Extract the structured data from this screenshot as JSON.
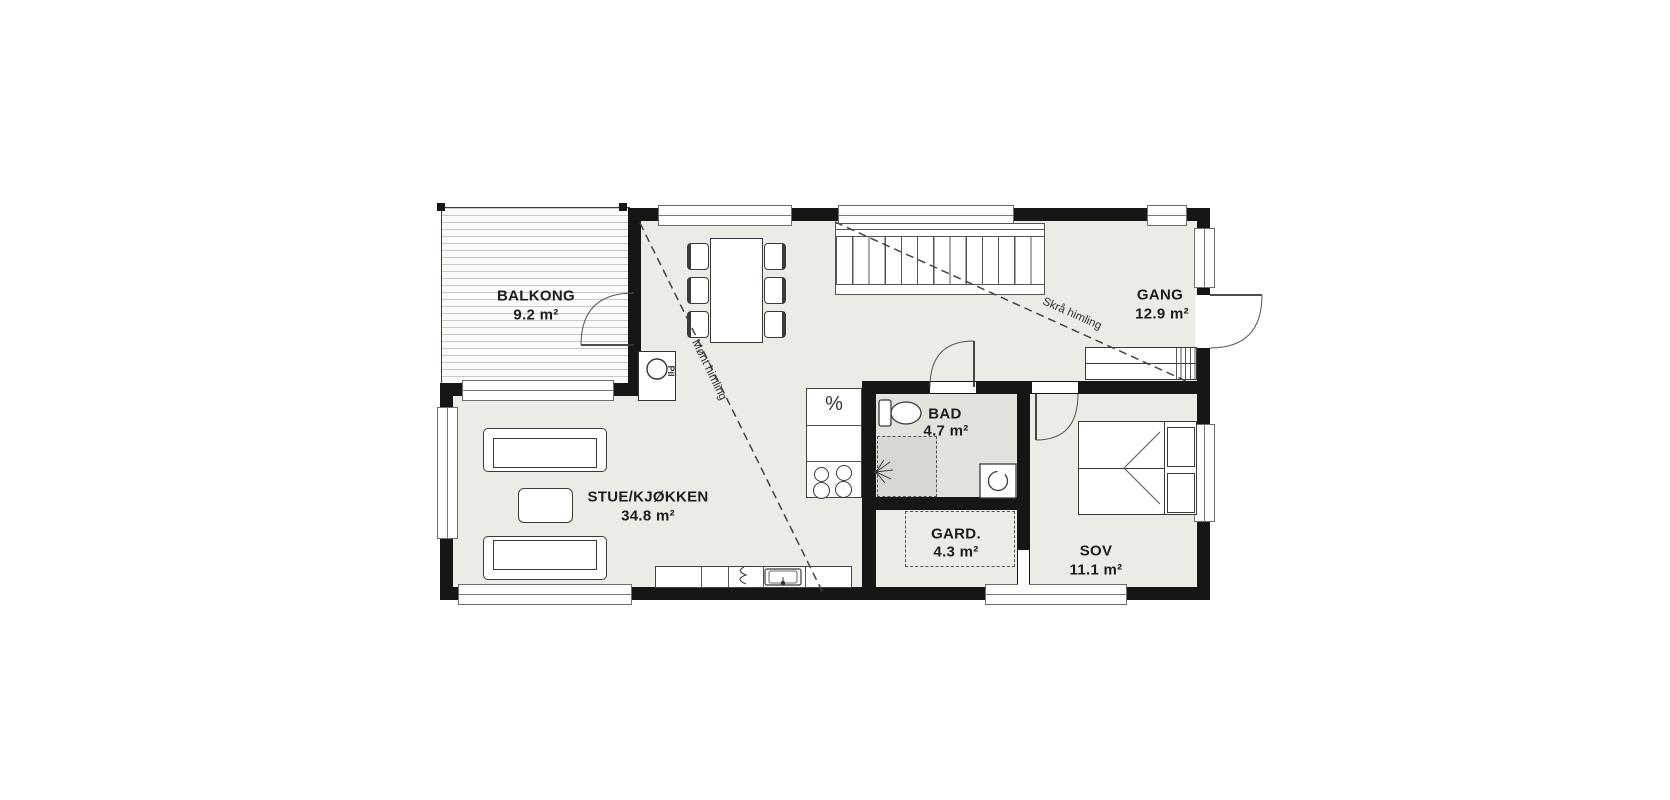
{
  "rooms": {
    "balkong": {
      "name": "BALKONG",
      "area": "9.2 m²"
    },
    "stue": {
      "name": "STUE/KJØKKEN",
      "area": "34.8 m²"
    },
    "gang": {
      "name": "GANG",
      "area": "12.9 m²"
    },
    "bad": {
      "name": "BAD",
      "area": "4.7 m²"
    },
    "gard": {
      "name": "GARD.",
      "area": "4.3 m²"
    },
    "sov": {
      "name": "SOV",
      "area": "11.1 m²"
    }
  },
  "annotations": {
    "sloped_ceiling": "Skrå himling",
    "ridge_ceiling": "Mønt himling",
    "pillar": "Pil",
    "oven_symbol": "%"
  },
  "colors": {
    "wall": "#161616",
    "floor": "#edebe6",
    "bathroom_floor": "#e3e2dd",
    "shower_floor": "#d8d7d1"
  }
}
